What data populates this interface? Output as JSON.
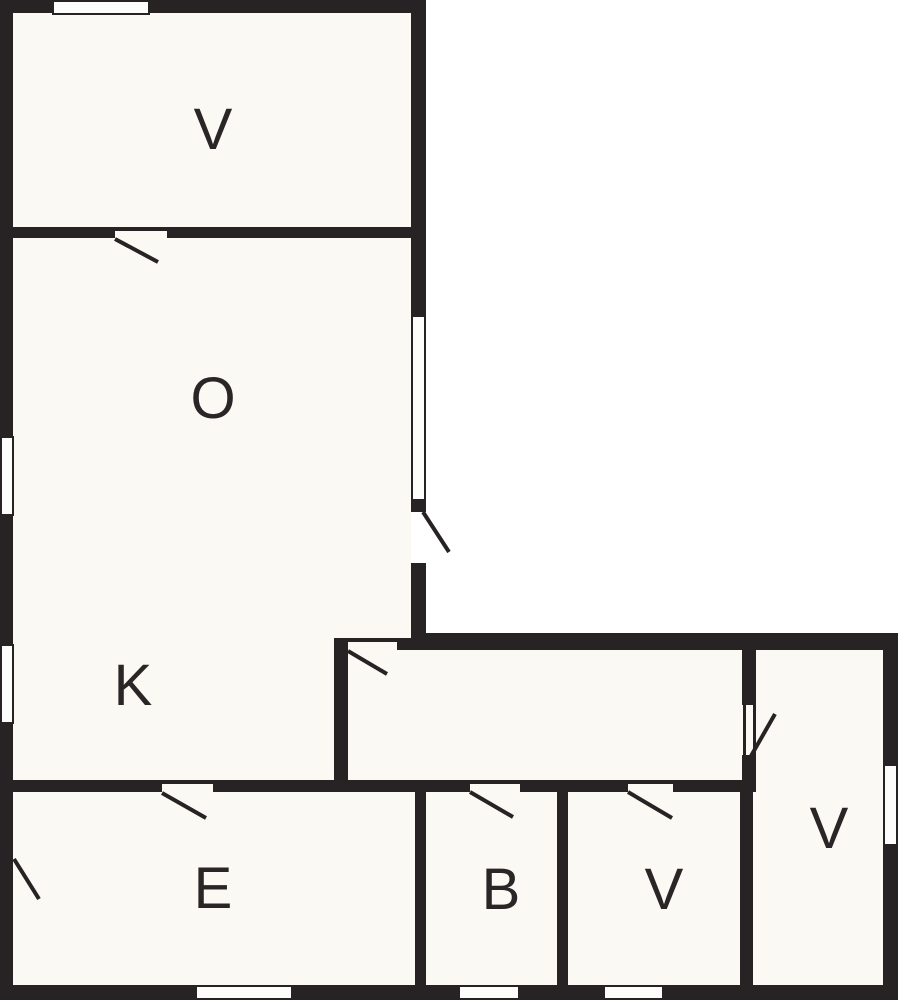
{
  "floorplan": {
    "title": "floor-plan",
    "rooms": [
      {
        "label": "V",
        "name": "bedroom-top"
      },
      {
        "label": "O",
        "name": "living-room"
      },
      {
        "label": "K",
        "name": "kitchen"
      },
      {
        "label": "E",
        "name": "entrance"
      },
      {
        "label": "B",
        "name": "bathroom"
      },
      {
        "label": "V",
        "name": "bedroom-bottom"
      },
      {
        "label": "V",
        "name": "bedroom-right"
      }
    ],
    "colors": {
      "wall": "#272223",
      "room_fill": "#faf9f3",
      "outside": "#ffffff",
      "label_text": "#2a2627"
    }
  }
}
